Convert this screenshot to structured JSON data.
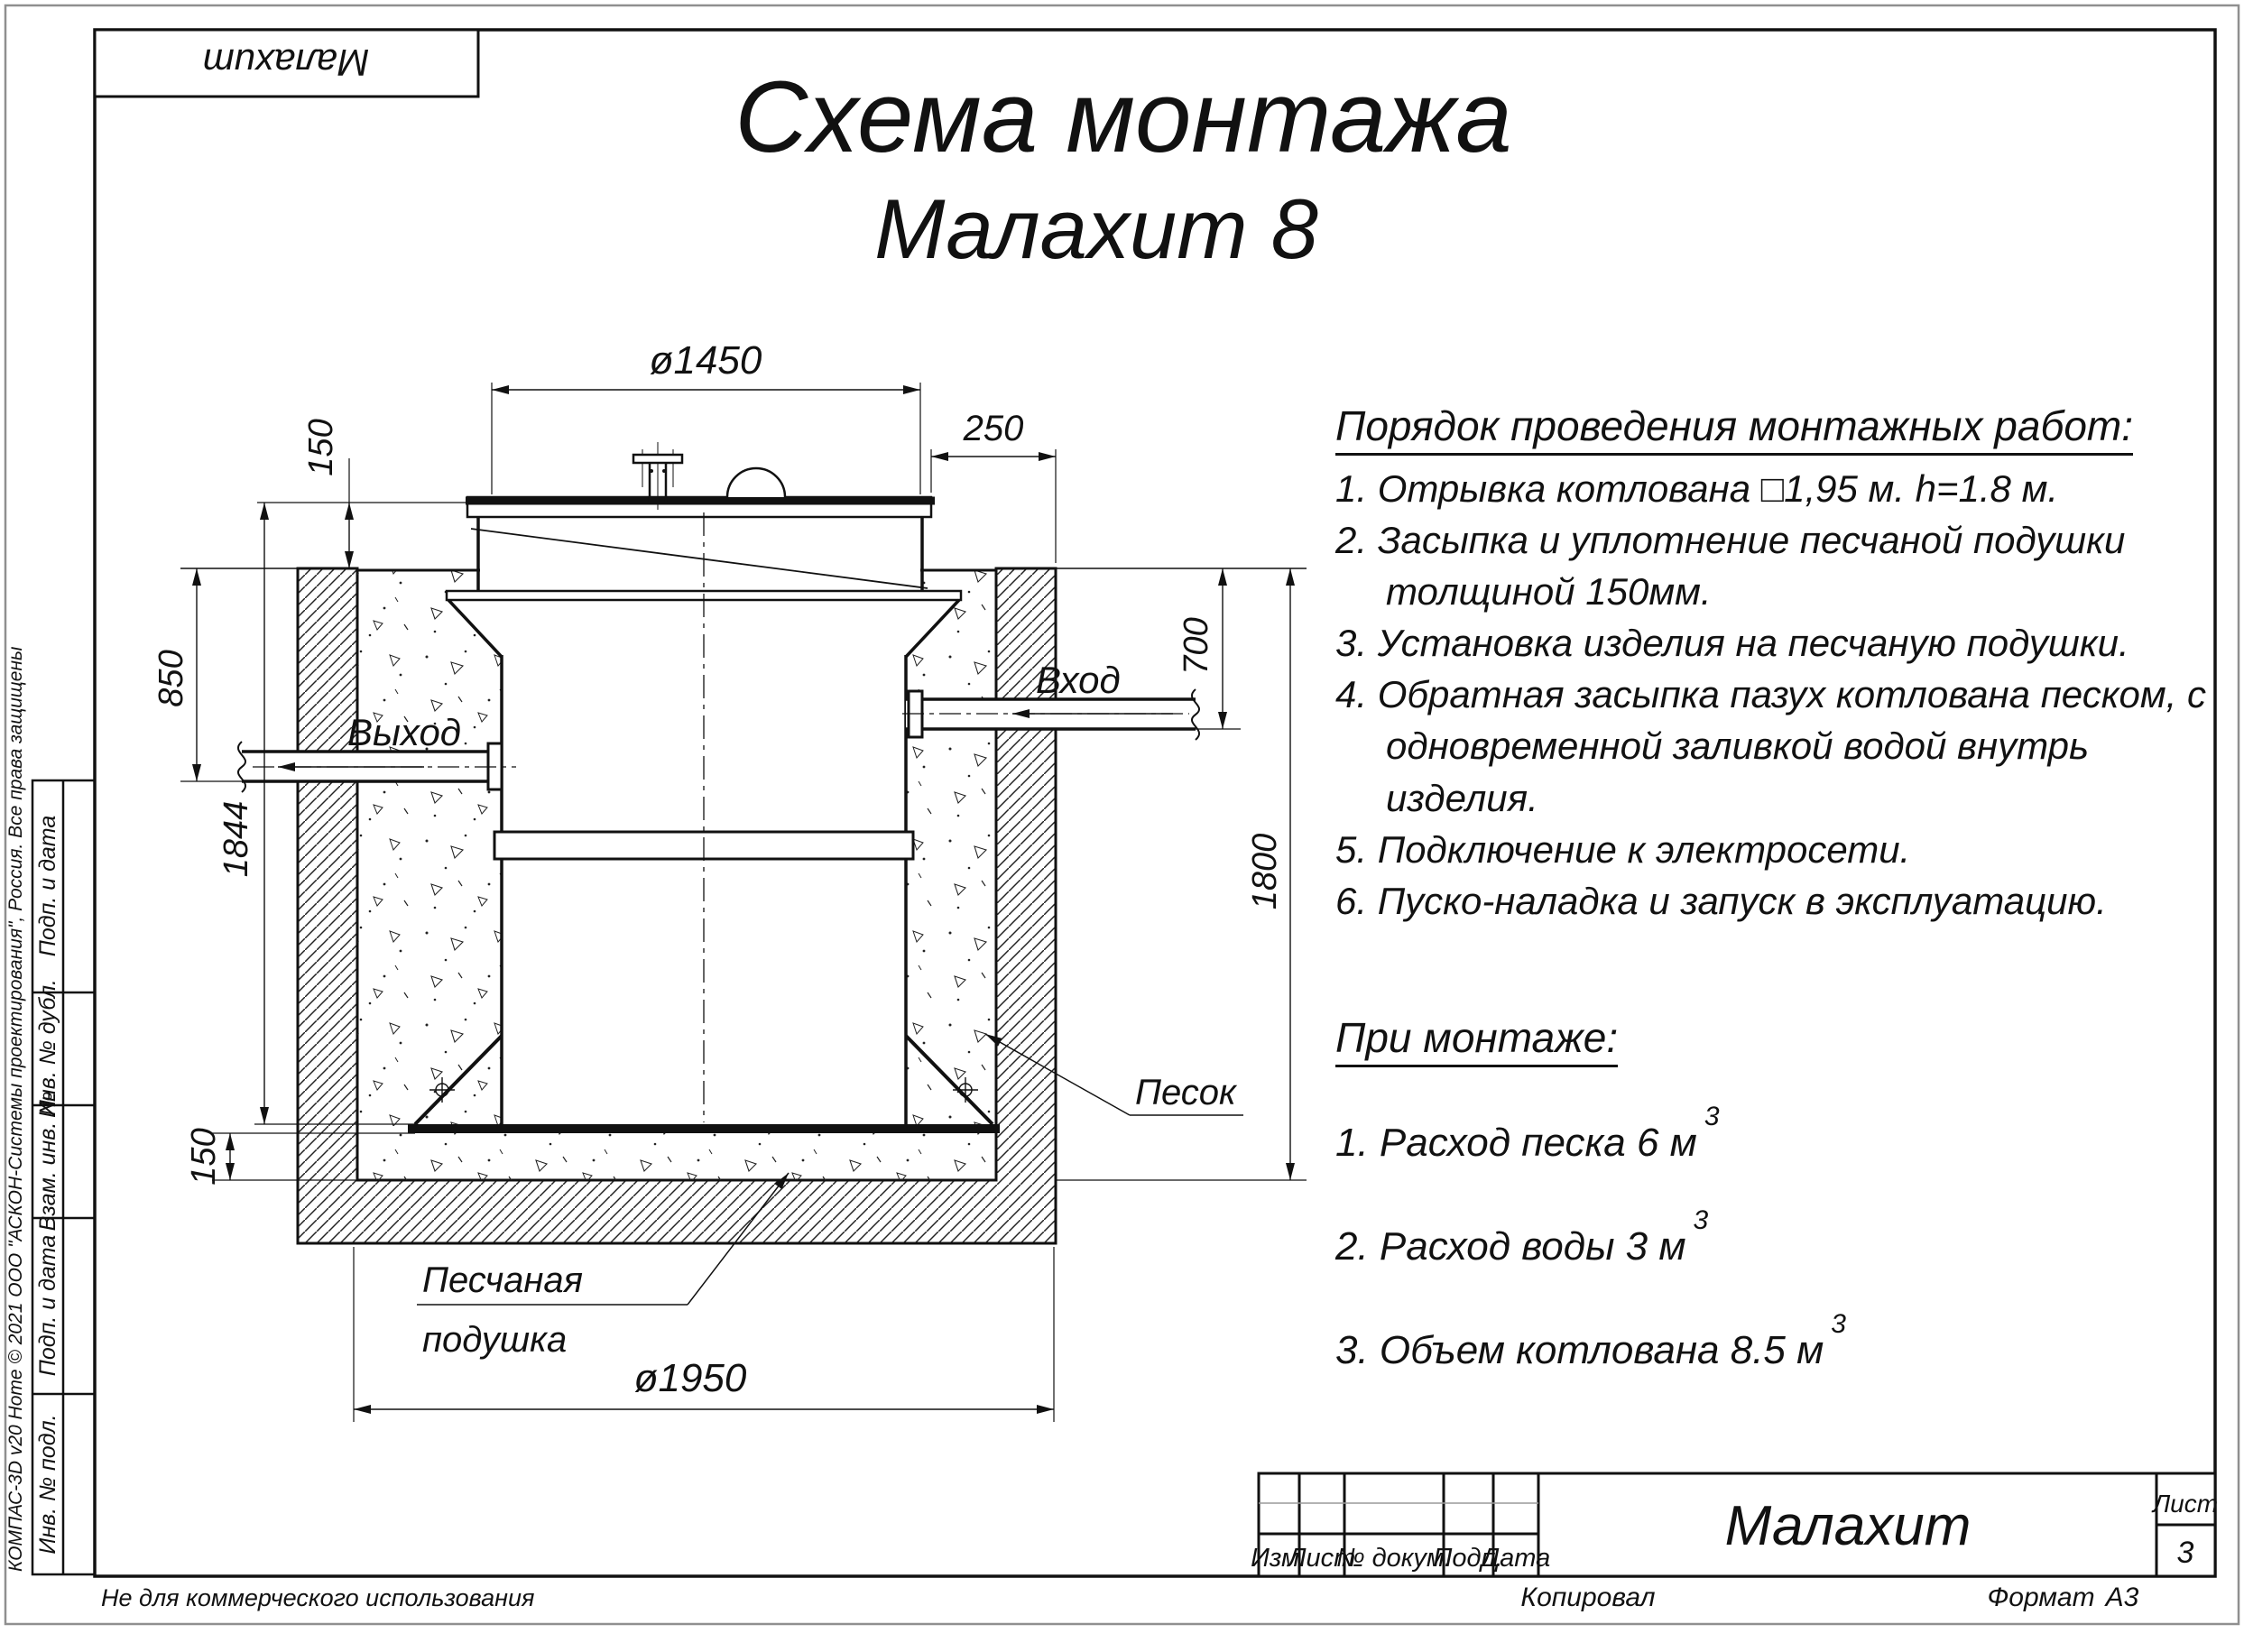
{
  "page": {
    "copyright_vertical": "КОМПАС-3D v20 Home © 2021 ООО \"АСКОН-Системы проектирования\", Россия. Все права защищены",
    "not_for_commercial": "Не для коммерческого использования"
  },
  "corner_stamp": {
    "title": "Малахит"
  },
  "title": {
    "line1": "Схема монтажа",
    "line2": "Малахит 8"
  },
  "instructions": {
    "heading": "Порядок проведения монтажных работ:",
    "items": [
      "1. Отрывка котлована □1,95 м. h=1.8 м.",
      "2. Засыпка и уплотнение песчаной подушки толщиной 150мм.",
      "3. Установка изделия на песчаную подушки.",
      "4. Обратная засыпка пазух котлована песком, с одновременной заливкой водой внутрь изделия.",
      "5. Подключение к электросети.",
      "6. Пуско-наладка и запуск в эксплуатацию."
    ]
  },
  "montage": {
    "heading": "При монтаже:",
    "items": [
      {
        "text": "1. Расход песка 6 м",
        "sup": "3"
      },
      {
        "text": "2. Расход воды 3 м",
        "sup": "3"
      },
      {
        "text": "3. Объем котлована 8.5 м",
        "sup": "3"
      }
    ]
  },
  "drawing": {
    "dims": {
      "d1450": "ø1450",
      "d250": "250",
      "d150_top": "150",
      "d850": "850",
      "d1844": "1844",
      "d150_bottom": "150",
      "d700": "700",
      "d1800": "1800",
      "d1950": "ø1950"
    },
    "labels": {
      "inlet": "Вход",
      "outlet": "Выход",
      "sand": "Песок",
      "cushion_line1": "Песчаная",
      "cushion_line2": "подушка"
    }
  },
  "side_stamp": {
    "cells": [
      "Подп. и дата",
      "Инв. № дубл.",
      "Взам. инв. №",
      "Подп. и дата",
      "Инв. № подл."
    ]
  },
  "title_block": {
    "cols": {
      "izm": "Изм.",
      "list": "Лист",
      "doc": "№ докум.",
      "podp": "Подп.",
      "data": "Дата"
    },
    "name": "Малахит",
    "sheet_label": "Лист",
    "sheet_number": "3",
    "copied": "Копировал",
    "format_label": "Формат",
    "format_value": "А3"
  }
}
